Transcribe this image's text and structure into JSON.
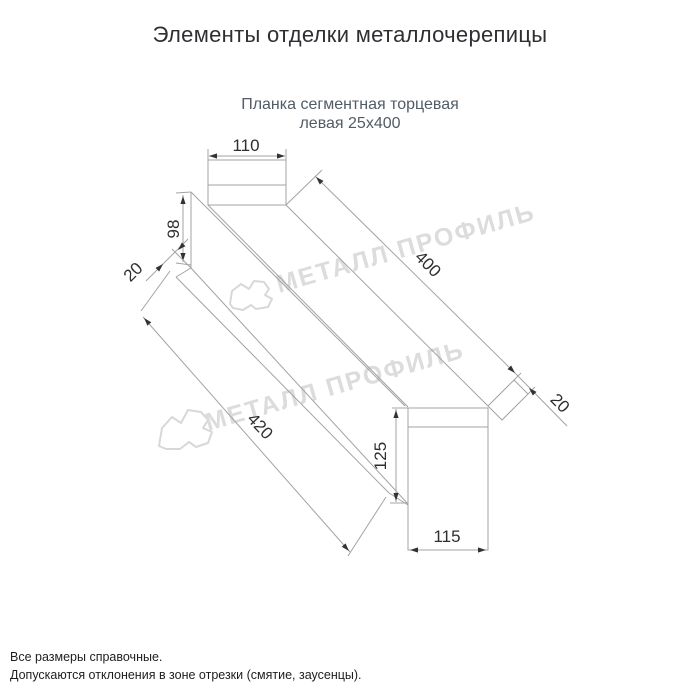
{
  "page": {
    "title": "Элементы отделки металлочерепицы",
    "subtitle_line1": "Планка сегментная торцевая",
    "subtitle_line2": "левая 25х400",
    "footer_line1": "Все размеры справочные.",
    "footer_line2": "Допускаются отклонения в зоне отрезки (смятие, заусенцы)."
  },
  "watermark": {
    "text": "МЕТАЛЛ ПРОФИЛЬ",
    "color": "#dcdcdc"
  },
  "drawing": {
    "dimensions": {
      "top_flange_width": "110",
      "end_tab_height": "98",
      "hem_top": "20",
      "length": "400",
      "hem_end": "20",
      "total_diagonal_length": "420",
      "bottom_height": "125",
      "bottom_flange_width": "115"
    },
    "colors": {
      "outline": "#a3a3a3",
      "dimension_text": "#2f2f2f",
      "title_text": "#2f2f33",
      "subtitle_text": "#515c66",
      "watermark": "#dcdcdc"
    }
  }
}
